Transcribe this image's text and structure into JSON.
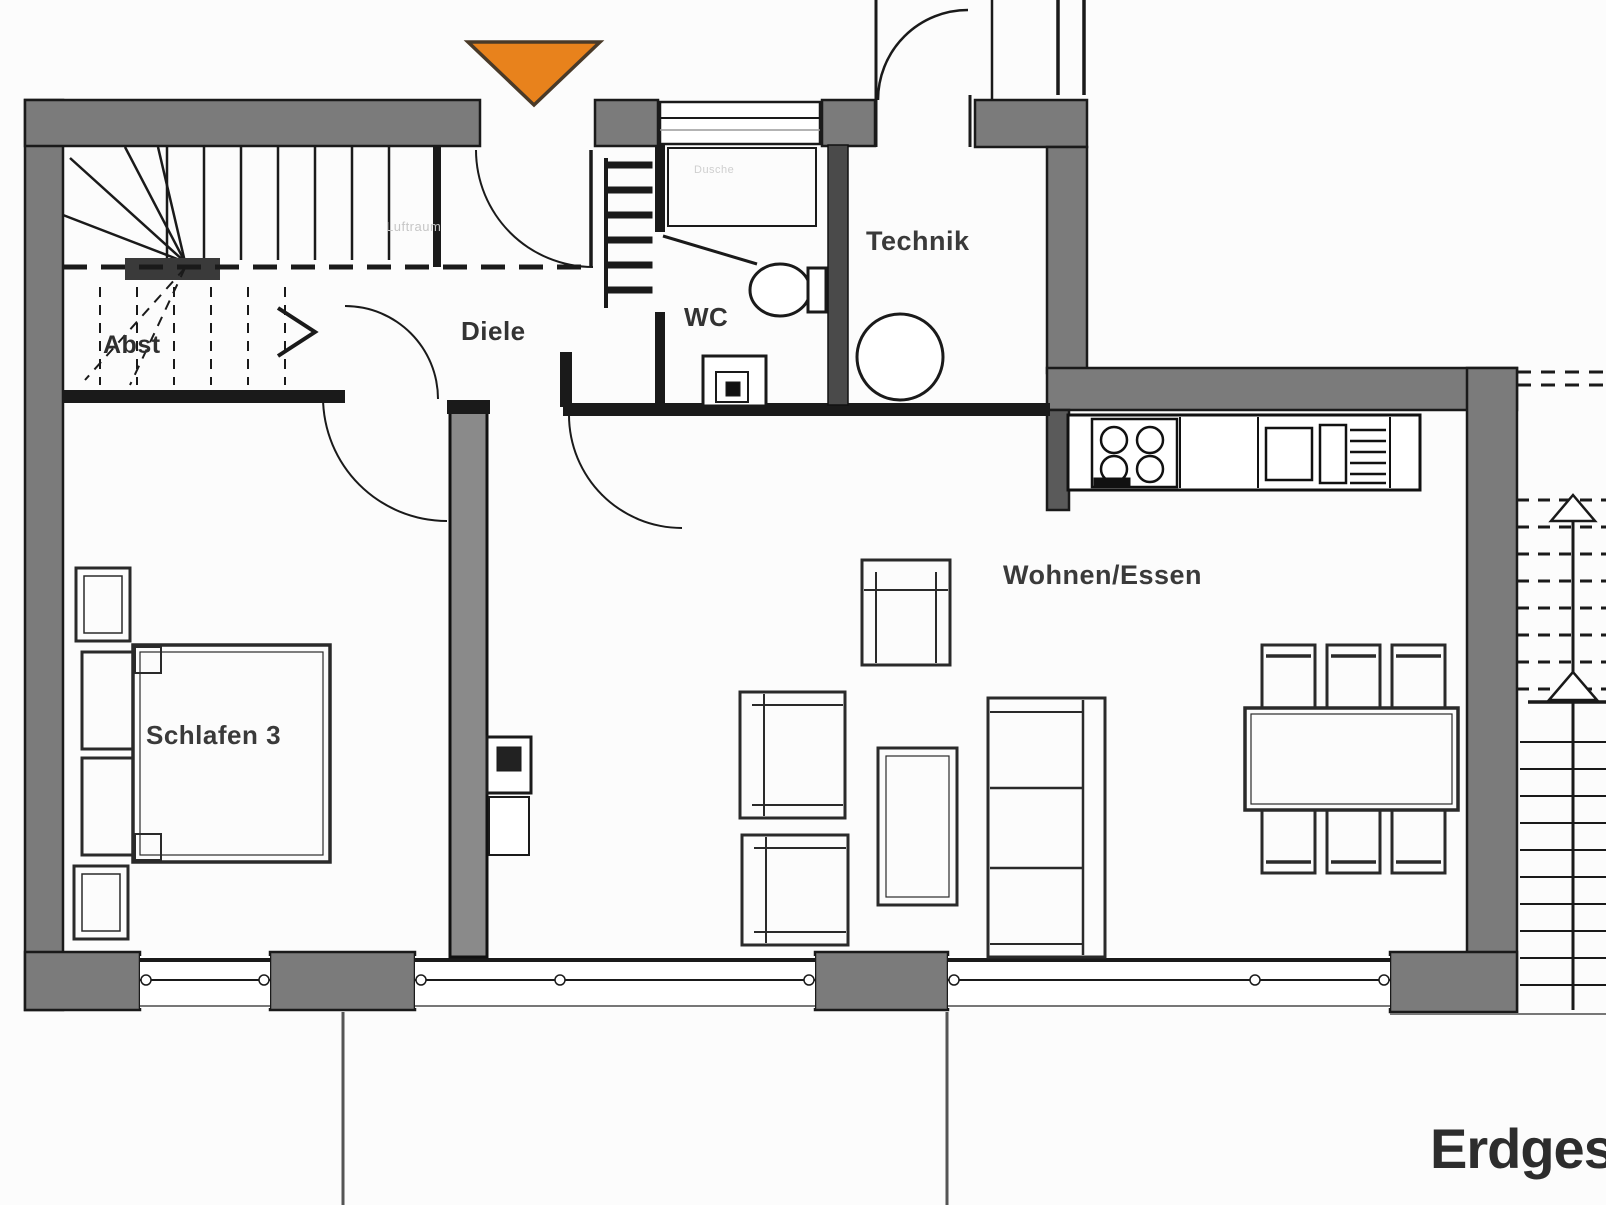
{
  "plan": {
    "title": "Erdgeschoss",
    "rooms": [
      {
        "id": "abst",
        "label": "Abst"
      },
      {
        "id": "diele",
        "label": "Diele"
      },
      {
        "id": "wc",
        "label": "WC"
      },
      {
        "id": "technik",
        "label": "Technik"
      },
      {
        "id": "wohnen",
        "label": "Wohnen/Essen"
      },
      {
        "id": "schlafen",
        "label": "Schlafen 3"
      }
    ],
    "faint_labels": [
      {
        "id": "luftraum",
        "label": "Luftraum"
      },
      {
        "id": "dusche",
        "label": "Dusche"
      }
    ],
    "symbols": {
      "entrance_marker": "orange-triangle-down",
      "stair_direction": "arrow-up",
      "stove_burners": 4,
      "dining_chairs": 6
    },
    "colors": {
      "wall_gray": "#7b7b7b",
      "line_black": "#1a1a1a",
      "entrance_orange": "#e8821c",
      "faint_text": "#c6c6c6",
      "background": "#fcfcfc"
    }
  }
}
